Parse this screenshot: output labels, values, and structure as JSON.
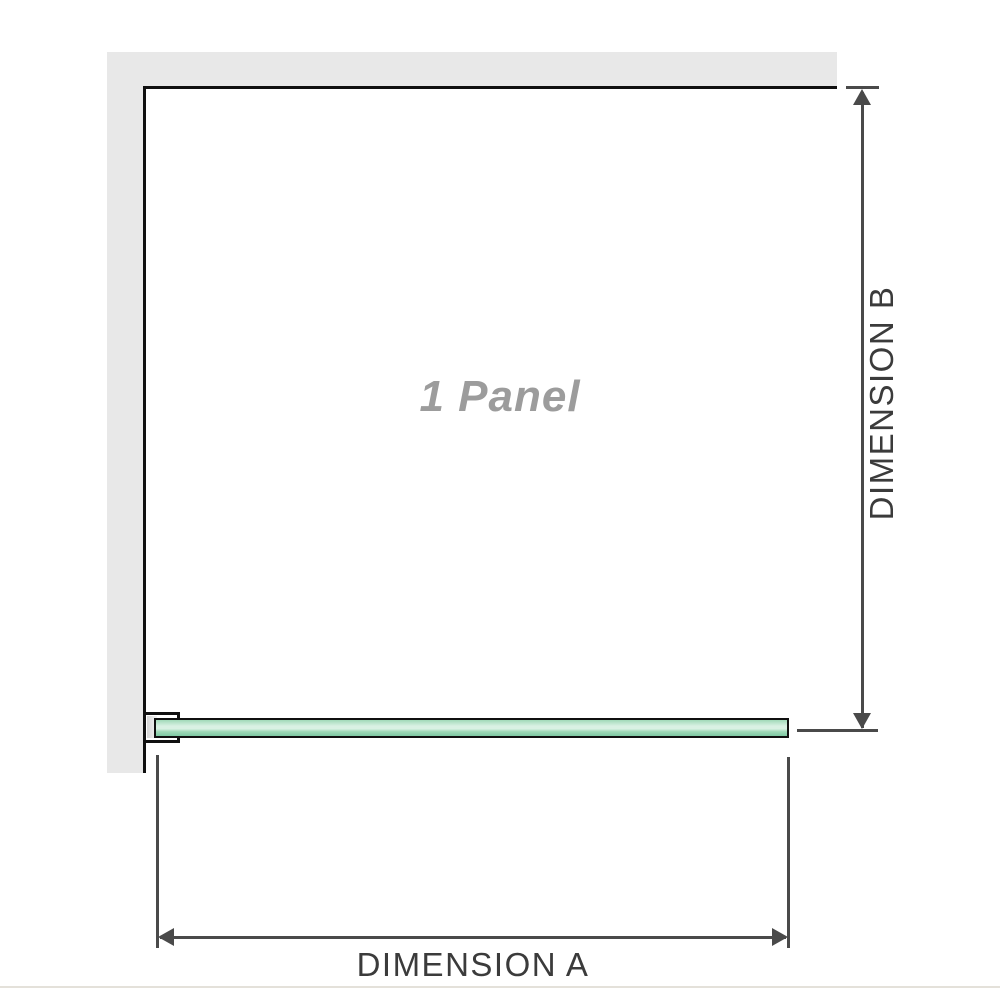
{
  "diagram": {
    "panel_label": "1 Panel",
    "dimension_a_label": "DIMENSION A",
    "dimension_b_label": "DIMENSION B"
  },
  "colors": {
    "wall": "#e8e8e8",
    "outline": "#101010",
    "dimension": "#4a4a4a",
    "label_text": "#3b3b3b",
    "panel_text": "#9c9c9c",
    "glass_light": "#d9f1e3",
    "glass_mid": "#a0d9b8",
    "glass_dark": "#7dc9a3"
  }
}
